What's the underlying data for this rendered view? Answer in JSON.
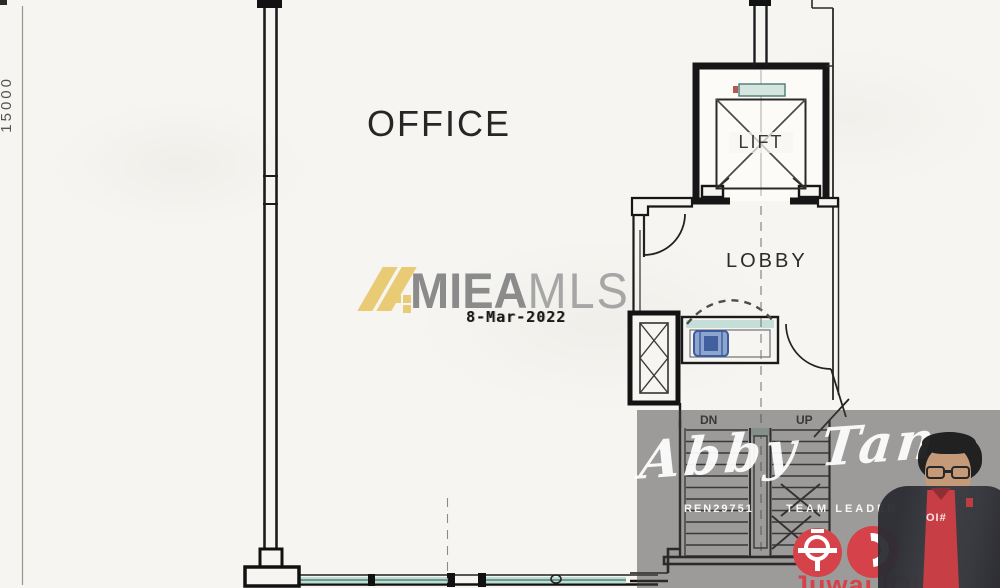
{
  "plan": {
    "room_label": "OFFICE",
    "lift_label": "LIFT",
    "lobby_label": "LOBBY",
    "stairs_down_label": "DN",
    "stairs_up_label": "UP",
    "dimension_label": "15000"
  },
  "mls_watermark": {
    "brand_primary": "MIEA",
    "brand_secondary": "MLS",
    "date": "8-Mar-2022",
    "logo_gold": "#e9cb76",
    "brand_primary_color": "#8b8b8b",
    "brand_secondary_color": "#a6a6a6"
  },
  "agent_watermark": {
    "name": "Abby Tan",
    "ren_no": "REN29751",
    "title": "TEAM LEADER",
    "brand": "Juwai IQI",
    "shirt_text": "OI#",
    "accent_red": "#d6424a",
    "overlay_gray": "rgba(66,66,66,0.5)"
  },
  "palette": {
    "paper": "#f6f5f1",
    "ink": "#1c1c1c",
    "glazing_teal": "#bfdcd4",
    "fixture_blue": "#3b5c9e"
  }
}
